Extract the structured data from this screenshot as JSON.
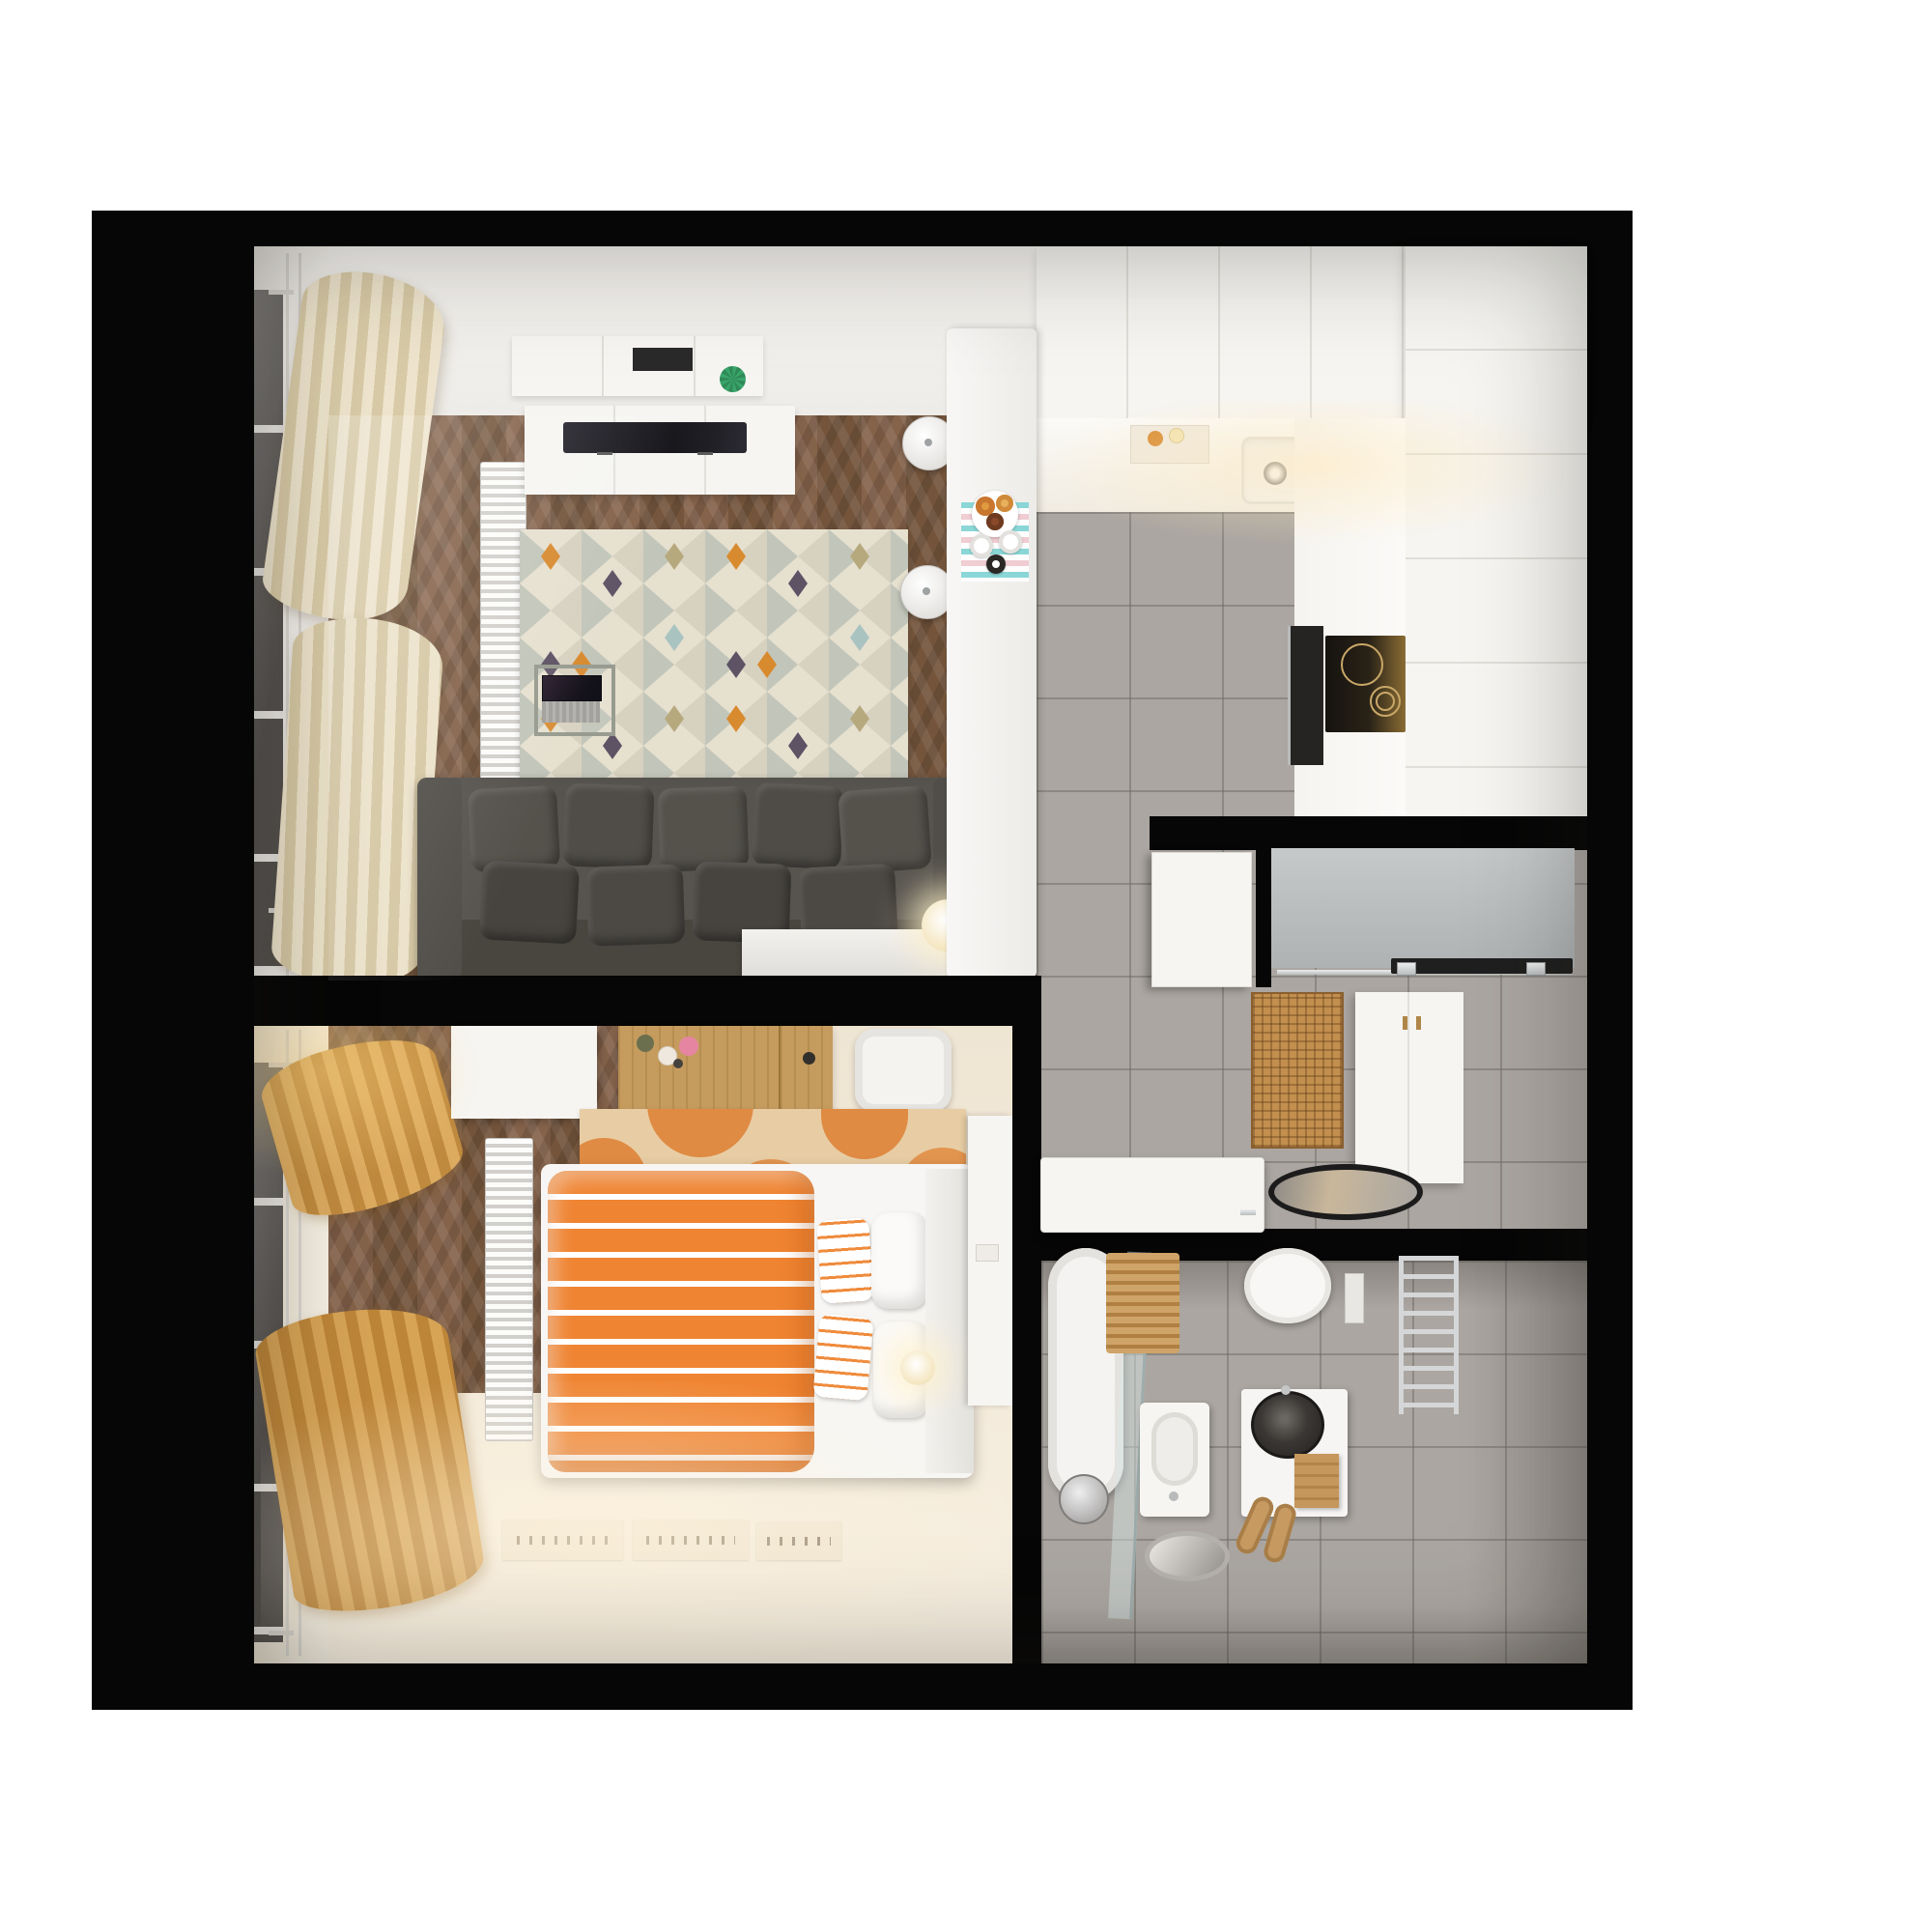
{
  "title": "top-down-3d-apartment-floor-plan-render",
  "colors": {
    "wall-black": "#060606",
    "wood-floor": "#7d5c40",
    "gray-tile": "#aba6a1",
    "bedroom-floor-cream": "#f2e9d9",
    "furniture-white": "#f6f5f2",
    "sofa-gray": "#56524d",
    "accent-orange": "#ee8532",
    "rug-cream": "#e6e0cf",
    "rug-sage": "#c2c6ba",
    "rug-orange": "#d88a2f",
    "rug-purple": "#5d5365",
    "curtain-cream": "#e7ddc2",
    "curtain-gold": "#d3a057",
    "rattan-tan": "#c28f4e",
    "chrome": "#cfd0d1",
    "plant-green": "#3aa56a",
    "cooktop-black": "#1c1814"
  },
  "rooms": [
    {
      "name": "living-room",
      "items": [
        "window-wall",
        "cream-curtains",
        "radiator",
        "wall-shelf",
        "plant",
        "tv-console",
        "tv",
        "patterned-rug",
        "laptop-side-table",
        "laptop",
        "gray-sofa",
        "sofa-cushions",
        "sphere-floor-lamp",
        "white-sideboard"
      ]
    },
    {
      "name": "kitchen",
      "items": [
        "upper-cabinets",
        "worktop",
        "cutting-board",
        "sink",
        "tall-cabinets",
        "oven",
        "induction-cooktop",
        "breakfast-bar",
        "bar-stools",
        "striped-placemat",
        "donut-plate",
        "coffee-cups"
      ]
    },
    {
      "name": "hallway",
      "items": [
        "sliding-wardrobe-niche",
        "door-track",
        "open-white-door",
        "rattan-doormat",
        "shoe-console",
        "oval-floor-mirror",
        "open-bathroom-door"
      ]
    },
    {
      "name": "bedroom",
      "items": [
        "gold-curtains",
        "radiator",
        "wardrobe",
        "wooden-desk",
        "cosmetics",
        "white-chair",
        "orange-blob-rug",
        "bed-frame",
        "orange-striped-duvet",
        "striped-pillows",
        "white-pillows",
        "bedside-column",
        "ball-lamp",
        "wall-prints"
      ]
    },
    {
      "name": "bathroom",
      "items": [
        "bathtub",
        "glass-shower-screen",
        "shower-head",
        "wooden-bath-mat",
        "wall-hung-toilet",
        "flush-plate",
        "towel-radiator",
        "bidet-basin",
        "vanity-unit",
        "black-vessel-sink",
        "towels",
        "slippers",
        "floor-mirror-disc"
      ]
    }
  ]
}
